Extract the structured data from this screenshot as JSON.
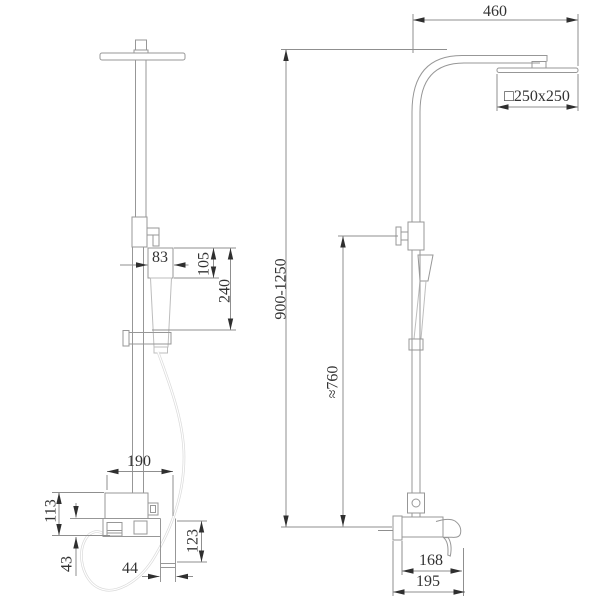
{
  "colors": {
    "background": "#ffffff",
    "drawing_line": "#979797",
    "light_line": "#cfcfcf",
    "dimension_line": "#8f8f8f",
    "text": "#333333",
    "arrow": "#2f2f2f"
  },
  "front_view": {
    "dims": {
      "hand_shower_width": "83",
      "hand_shower_length": "105",
      "head_to_bracket": "240",
      "mixer_width": "190",
      "mixer_height": "113",
      "spout_drop": "43",
      "spout_width": "44",
      "spout_height": "123"
    }
  },
  "side_view": {
    "dims": {
      "arm_reach": "460",
      "head_size": "□250x250",
      "column_height": "900-1250",
      "hand_shower_height": "≈760",
      "spout_reach": "168",
      "overall_depth": "195"
    }
  }
}
